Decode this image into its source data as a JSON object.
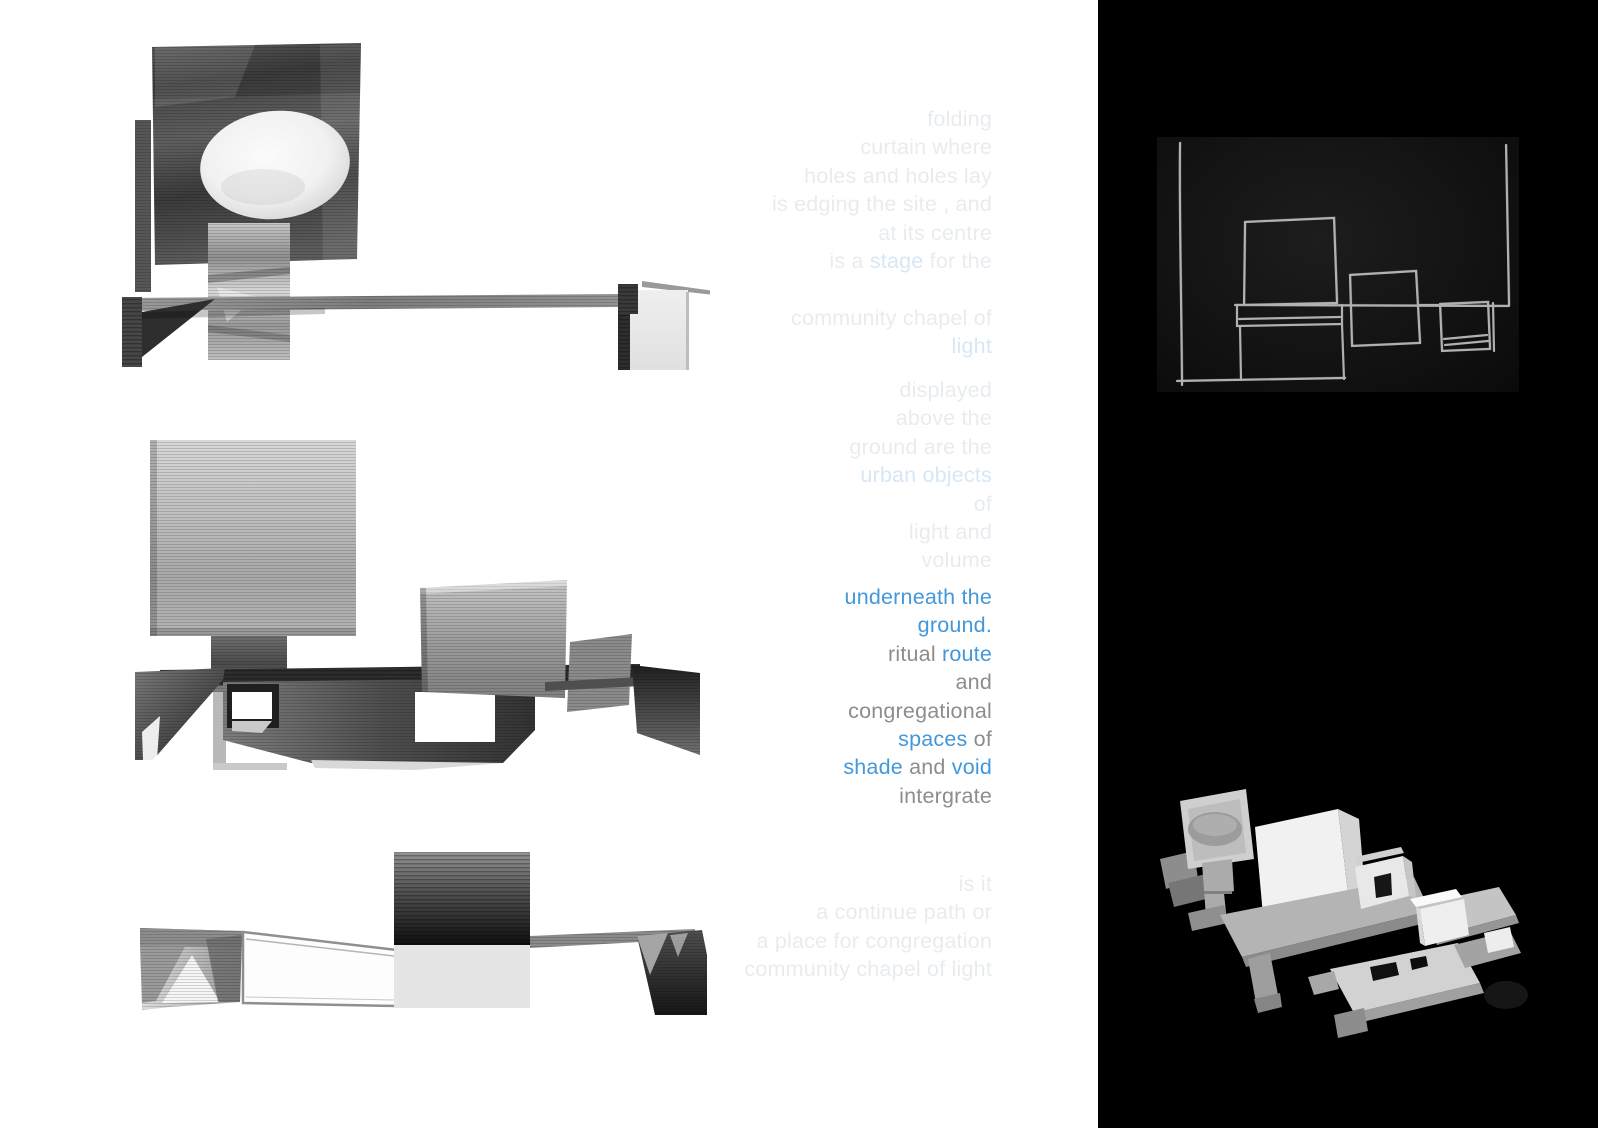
{
  "page": {
    "background": "#ffffff",
    "panel_background": "#000000"
  },
  "colors": {
    "accent_blue": "#4298da",
    "text_gray": "#8d8d8d",
    "faint_gray": "#e8ecef",
    "faint_blue": "#d7e7f5"
  },
  "text_column": {
    "blocks": [
      {
        "name": "intro",
        "lines": [
          [
            {
              "t": "folding",
              "c": "faint"
            }
          ],
          [
            {
              "t": "curtain where",
              "c": "faint"
            }
          ],
          [
            {
              "t": "holes and holes lay",
              "c": "faint"
            }
          ],
          [
            {
              "t": "is edging the site , and",
              "c": "faint"
            }
          ],
          [
            {
              "t": "at its centre",
              "c": "faint"
            }
          ],
          [
            {
              "t": "is a ",
              "c": "faint"
            },
            {
              "t": "stage",
              "c": "faintBlue"
            },
            {
              "t": " for the",
              "c": "faint"
            }
          ],
          [],
          [
            {
              "t": "community chapel of",
              "c": "faint"
            }
          ],
          [
            {
              "t": "light",
              "c": "faintBlue"
            }
          ]
        ]
      },
      {
        "name": "objects",
        "lines": [
          [
            {
              "t": "displayed",
              "c": "faint"
            }
          ],
          [
            {
              "t": "above the",
              "c": "faint"
            }
          ],
          [
            {
              "t": "ground are the",
              "c": "faint"
            }
          ],
          [
            {
              "t": "urban objects",
              "c": "faintBlue"
            }
          ],
          [
            {
              "t": "of",
              "c": "faint"
            }
          ],
          [
            {
              "t": "light and",
              "c": "faint"
            }
          ],
          [
            {
              "t": "volume",
              "c": "faint"
            }
          ]
        ]
      },
      {
        "name": "main",
        "lines": [
          [
            {
              "t": "underneath the",
              "c": "blue"
            }
          ],
          [
            {
              "t": "ground.",
              "c": "blue"
            }
          ],
          [
            {
              "t": "ritual ",
              "c": "gray"
            },
            {
              "t": "route",
              "c": "blue"
            }
          ],
          [
            {
              "t": "and",
              "c": "gray"
            }
          ],
          [
            {
              "t": "congregational",
              "c": "gray"
            }
          ],
          [
            {
              "t": "spaces",
              "c": "blue"
            },
            {
              "t": " of",
              "c": "gray"
            }
          ],
          [
            {
              "t": "shade",
              "c": "blue"
            },
            {
              "t": " and ",
              "c": "gray"
            },
            {
              "t": "void",
              "c": "blue"
            }
          ],
          [
            {
              "t": "intergrate",
              "c": "gray"
            }
          ]
        ]
      },
      {
        "name": "question",
        "lines": [
          [
            {
              "t": "is it",
              "c": "faint"
            }
          ],
          [
            {
              "t": "a continue path  or",
              "c": "faint"
            }
          ],
          [
            {
              "t": "a place for congregation",
              "c": "faint"
            }
          ],
          [
            {
              "t": "community chapel of light",
              "c": "faint"
            }
          ]
        ]
      }
    ]
  },
  "figures": {
    "left": [
      {
        "name": "model-scan-top"
      },
      {
        "name": "model-scan-middle"
      },
      {
        "name": "model-scan-bottom"
      }
    ],
    "right": [
      {
        "name": "chalk-plan-sketch"
      },
      {
        "name": "paper-model-photo"
      }
    ]
  }
}
